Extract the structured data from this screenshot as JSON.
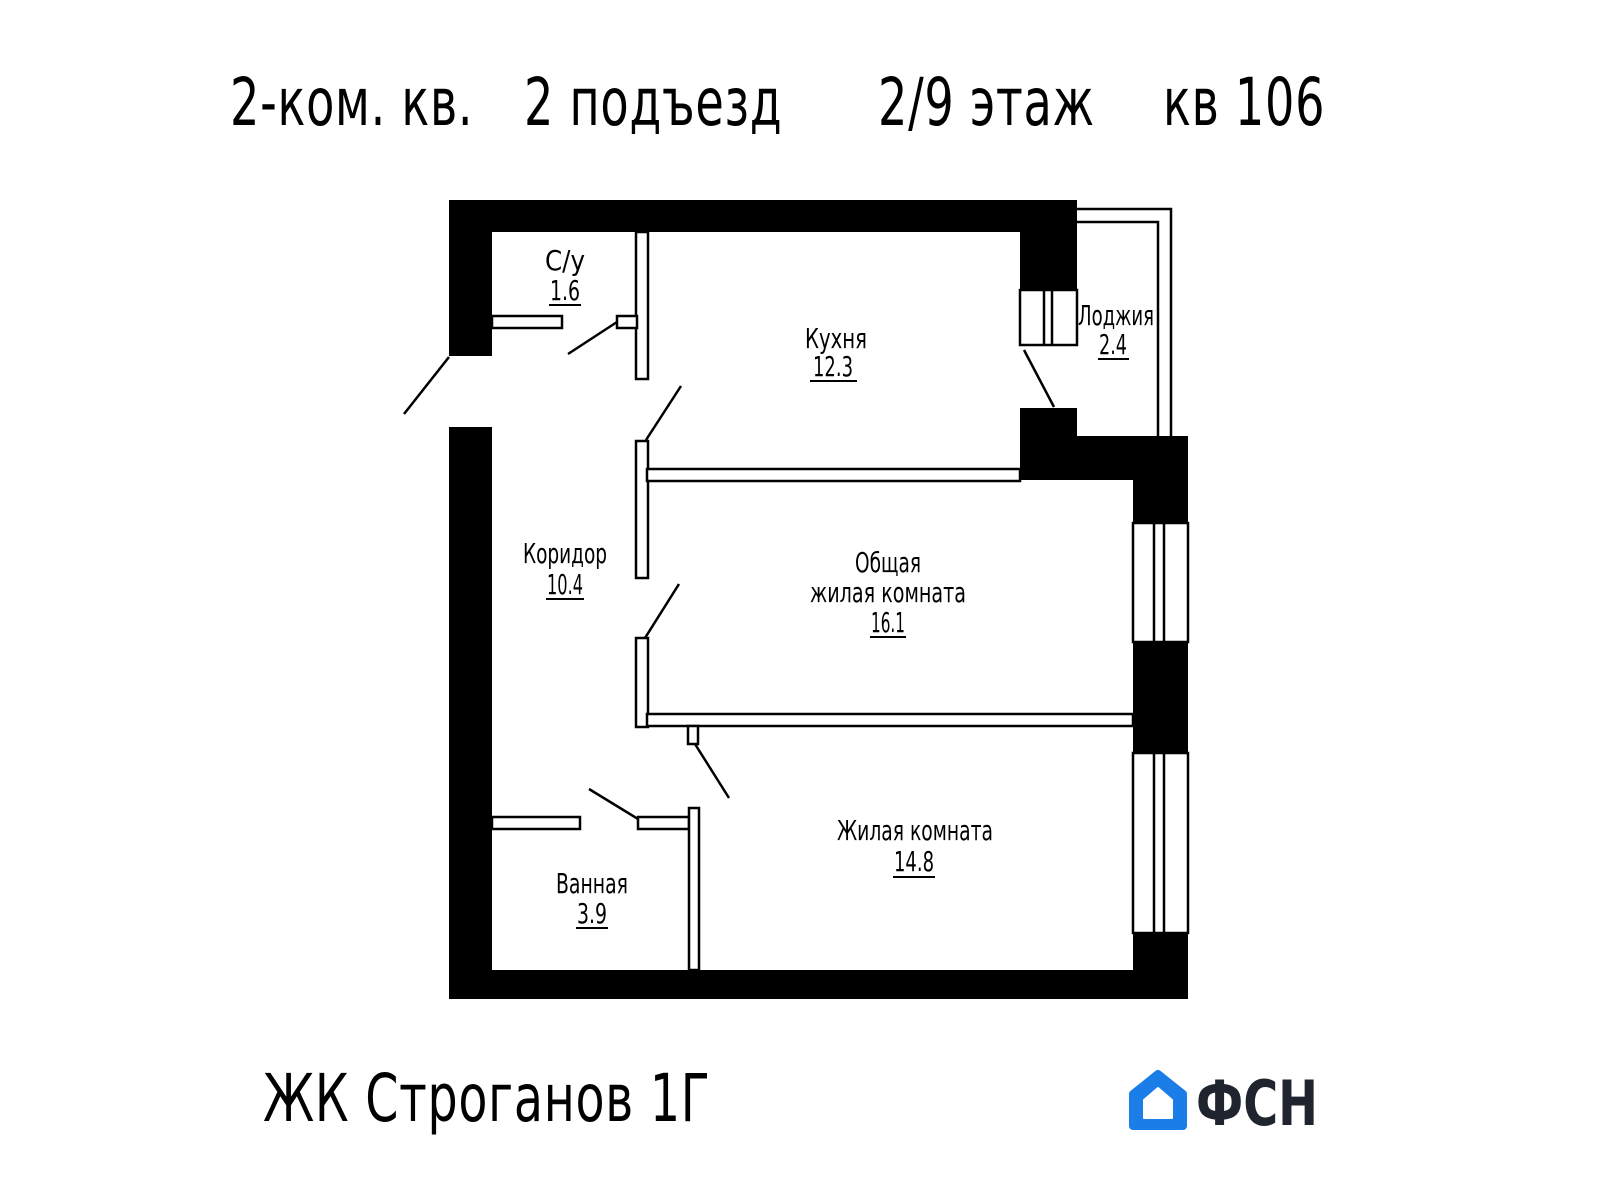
{
  "header": {
    "apartment_type": "2-ком. кв.",
    "entrance": "2 подъезд",
    "floor": "2/9 этаж",
    "unit": "кв 106"
  },
  "plan": {
    "rooms": {
      "wc": {
        "name": "С/у",
        "area": "1.6"
      },
      "kitchen": {
        "name": "Кухня",
        "area": "12.3"
      },
      "loggia": {
        "name": "Лоджия",
        "area": "2.4"
      },
      "corridor": {
        "name": "Коридор",
        "area": "10.4"
      },
      "living": {
        "name_line1": "Общая",
        "name_line2": "жилая комната",
        "area": "16.1"
      },
      "bathroom": {
        "name": "Ванная",
        "area": "3.9"
      },
      "bedroom": {
        "name": "Жилая комната",
        "area": "14.8"
      }
    }
  },
  "footer": {
    "project": "ЖК Строганов 1Г",
    "logo_text": "ФСН"
  },
  "colors": {
    "plan_black": "#000000",
    "logo_blue": "#1b7de8",
    "logo_dark": "#20242e"
  }
}
